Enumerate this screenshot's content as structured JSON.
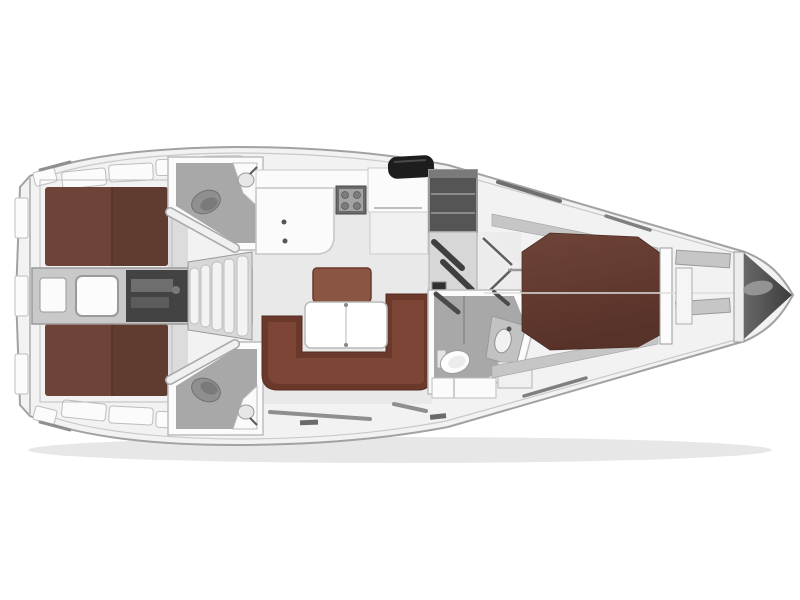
{
  "meta": {
    "title": "Sailing yacht interior layout plan — top view",
    "type": "floor-plan",
    "orientation": "bow-right-stern-left"
  },
  "palette": {
    "hull_fill": "#f2f2f2",
    "hull_stroke": "#a2a2a2",
    "deck_white": "#fbfbfb",
    "wall_line": "#bdbdbd",
    "floor_saloon": "#e9e9e9",
    "floor_corridor": "#c9c9c9",
    "floor_head": "#a8a8a8",
    "berth": "#6f4438",
    "berth_dark": "#573228",
    "settee": "#6b392b",
    "settee_inner": "#7c4535",
    "bench": "#8b5544",
    "table": "#ffffff",
    "engine": "#434343",
    "steps": "#f3f3f3",
    "cabinet": "#555555",
    "hatch": "#1d1d1d",
    "anchor": "#686868",
    "anchor_light": "#9a9a9a",
    "fixture": "#8f8f8f",
    "shelf": "#c6c6c6",
    "shadow": "#e7e7e7"
  }
}
